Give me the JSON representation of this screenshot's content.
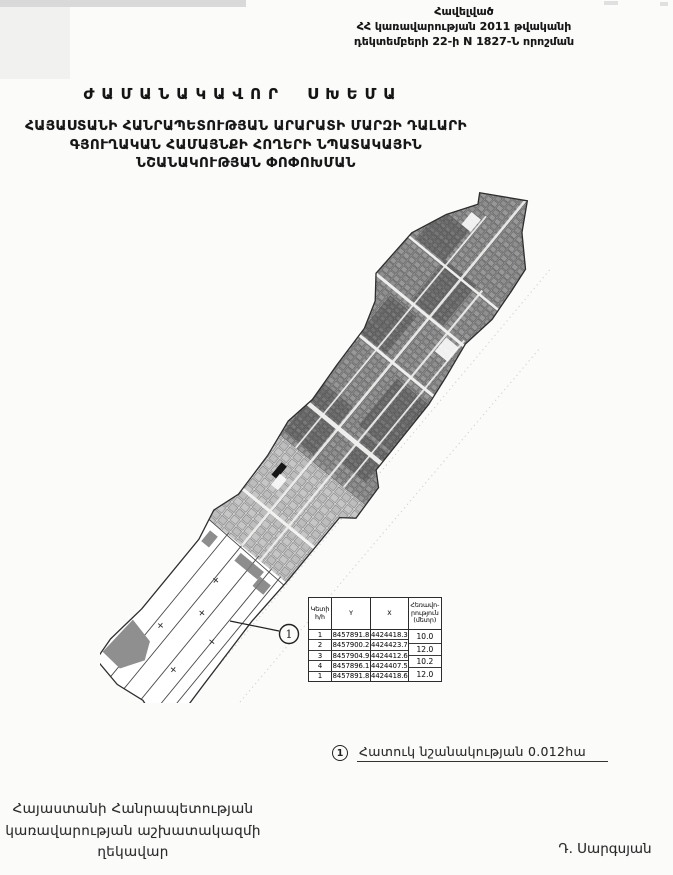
{
  "document": {
    "annex_note": [
      "Հավելված",
      "ՀՀ կառավարության 2011 թվականի",
      "դեկտեմբերի 22-ի N 1827-Ն որոշման"
    ],
    "title": "ԺԱՄԱՆԱԿԱՎՈՐ ՍԽԵՄԱ",
    "subtitle": [
      "ՀԱՅԱՍՏԱՆԻ ՀԱՆՐԱՊԵՏՈՒԹՅԱՆ ԱՐԱՐԱՏԻ ՄԱՐԶԻ ԴԱԼԱՐԻ",
      "ԳՅՈՒՂԱԿԱՆ ՀԱՄԱՅՆՔԻ ՀՈՂԵՐԻ ՆՊԱՏԱԿԱՅԻՆ",
      "ՆՇԱՆԱԿՈՒԹՅԱՆ ՓՈՓՈԽՄԱՆ"
    ]
  },
  "map": {
    "callout_marker": "1"
  },
  "coordinates_table": {
    "headers": {
      "point": [
        "Կետի",
        "հ/հ"
      ],
      "y": "Y",
      "x": "X",
      "distance": [
        "Հեռավո-",
        "րություն",
        "(մետր)"
      ]
    },
    "rows": [
      {
        "point": "1",
        "y": "8457891.8",
        "x": "4424418.3"
      },
      {
        "point": "2",
        "y": "8457900.2",
        "x": "4424423.7"
      },
      {
        "point": "3",
        "y": "8457904.9",
        "x": "4424412.6"
      },
      {
        "point": "4",
        "y": "8457896.1",
        "x": "4424407.5"
      },
      {
        "point": "1",
        "y": "8457891.8",
        "x": "4424418.6"
      }
    ],
    "distances": [
      "10.0",
      "12.0",
      "10.2",
      "12.0"
    ]
  },
  "legend": {
    "marker": "1",
    "label": "Հատուկ նշանակության  0.012հա"
  },
  "signatory": {
    "title_lines": [
      "Հայաստանի Հանրապետության",
      "կառավարության աշխատակազմի",
      "ղեկավար"
    ],
    "name": "Դ. Սարգսյան"
  },
  "colors": {
    "ink": "#1f1f1f",
    "scan_gray": "#d2d2d2",
    "map_parcel_gray": "#9a9a9a"
  }
}
